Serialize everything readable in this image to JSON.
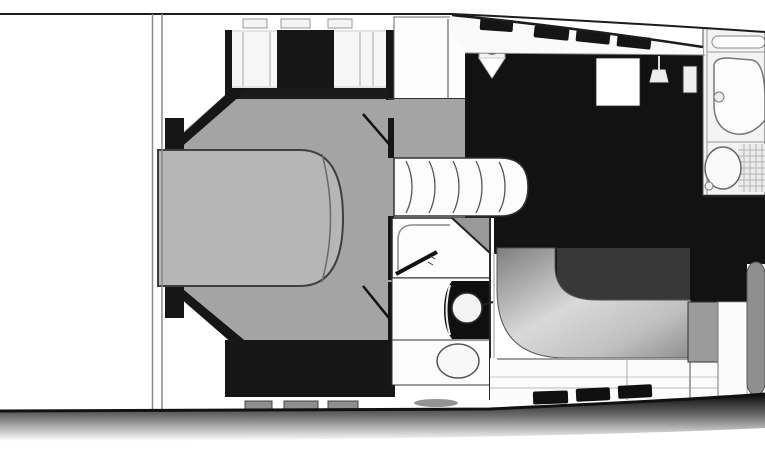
{
  "figure": {
    "type": "floor-plan",
    "text_labels": [],
    "window_count_top": 4,
    "window_count_bottom": 3,
    "hatch_count_bow": 3,
    "drawer_count_bow": 3,
    "stair_step_count": 5
  },
  "colors": {
    "background": "#ffffff",
    "hull_line": "#1c1c1c",
    "bulkhead_gray": "#8a8a8a",
    "floor_gray": "#a4a4a4",
    "bed_gray": "#b6b6b6",
    "bed_outline": "#3f3f3f",
    "cabinet_black": "#161616",
    "galley_black": "#121212",
    "panel_light": "#e3e3e3",
    "panel_white": "#f6f6f6",
    "fixture_white": "#fcfcfc",
    "table_dark": "#383838",
    "drawer_gray": "#8e8e8e",
    "corner_gray": "#999999",
    "block_gray": "#9b9b9b",
    "round_locker_gray": "#8f8f8f",
    "tile_line": "#b5b5b5"
  }
}
